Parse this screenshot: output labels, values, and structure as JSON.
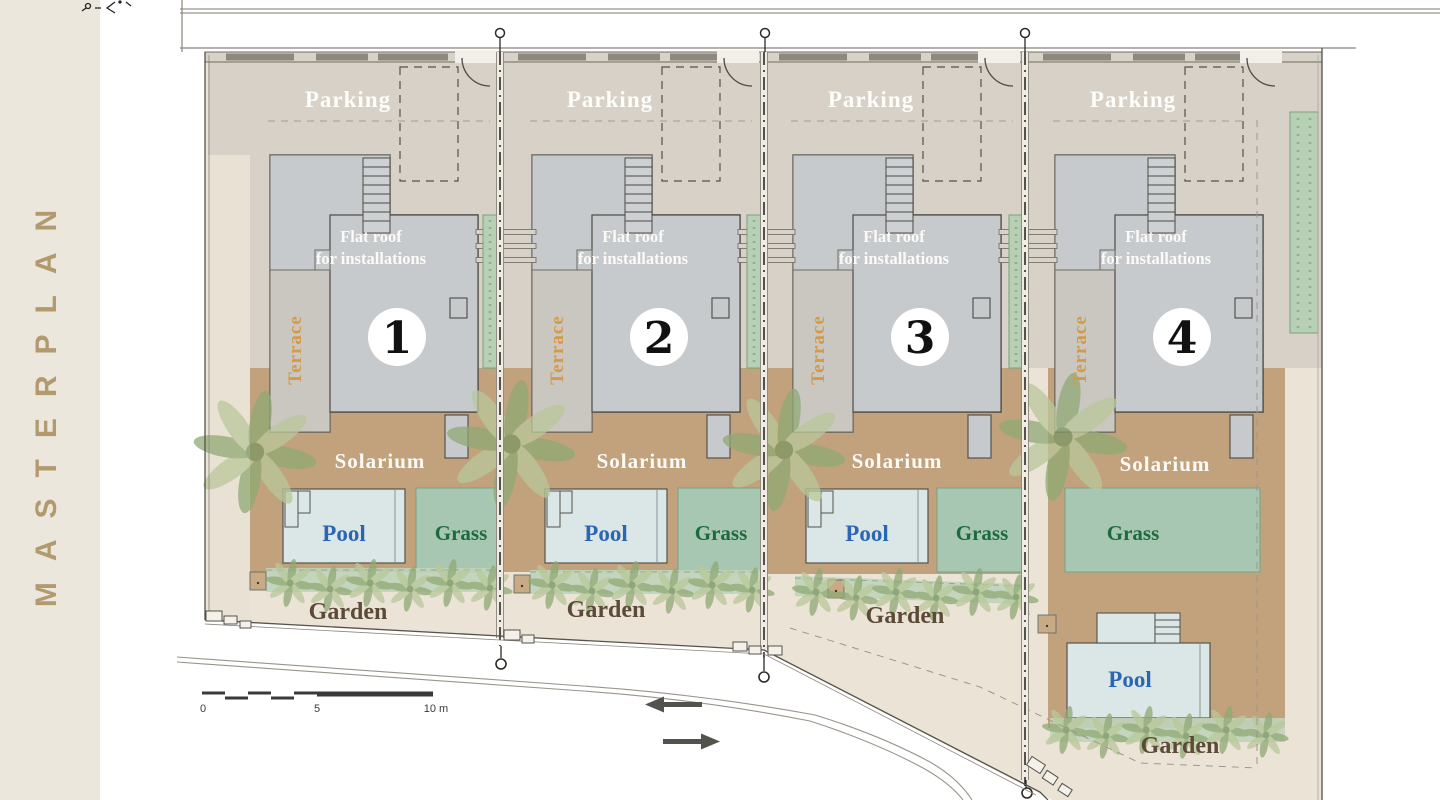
{
  "sidebar": {
    "title": "MASTERPLAN"
  },
  "plan": {
    "plots": [
      {
        "number": "1",
        "parking": "Parking",
        "flat_roof_line1": "Flat roof",
        "flat_roof_line2": "for installations",
        "terrace": "Terrace",
        "solarium": "Solarium",
        "pool": "Pool",
        "grass": "Grass",
        "garden": "Garden"
      },
      {
        "number": "2",
        "parking": "Parking",
        "flat_roof_line1": "Flat roof",
        "flat_roof_line2": "for installations",
        "terrace": "Terrace",
        "solarium": "Solarium",
        "pool": "Pool",
        "grass": "Grass",
        "garden": "Garden"
      },
      {
        "number": "3",
        "parking": "Parking",
        "flat_roof_line1": "Flat roof",
        "flat_roof_line2": "for installations",
        "terrace": "Terrace",
        "solarium": "Solarium",
        "pool": "Pool",
        "grass": "Grass",
        "garden": "Garden"
      },
      {
        "number": "4",
        "parking": "Parking",
        "flat_roof_line1": "Flat roof",
        "flat_roof_line2": "for installations",
        "terrace": "Terrace",
        "solarium": "Solarium",
        "pool": "Pool",
        "grass": "Grass",
        "garden": "Garden"
      }
    ],
    "scale_bar": {
      "zero": "0",
      "five": "5",
      "ten": "10 m"
    }
  },
  "icons": {
    "lamp_posts": "lamp-post-icon",
    "direction_arrows": [
      "arrow-left",
      "arrow-right"
    ],
    "north_marker": "survey-marker-icon",
    "trees": "palm-tree-icon"
  },
  "colors": {
    "sidebar_bg": "#ece7dd",
    "masterplan_text": "#b29a6e",
    "site_beige": "#ebe4d6",
    "parking_zone": "#d7d1c7",
    "house_gray": "#c7cacc",
    "solarium_tan": "#c1a27d",
    "grass_green": "#a7c7b2",
    "pool_fill": "#dbe7e7",
    "hedge_green": "#b7cfb4",
    "pool_text": "#2b66b3",
    "grass_text": "#1c6b3e",
    "garden_text": "#5c4a38",
    "terrace_text": "#d49a4c"
  }
}
